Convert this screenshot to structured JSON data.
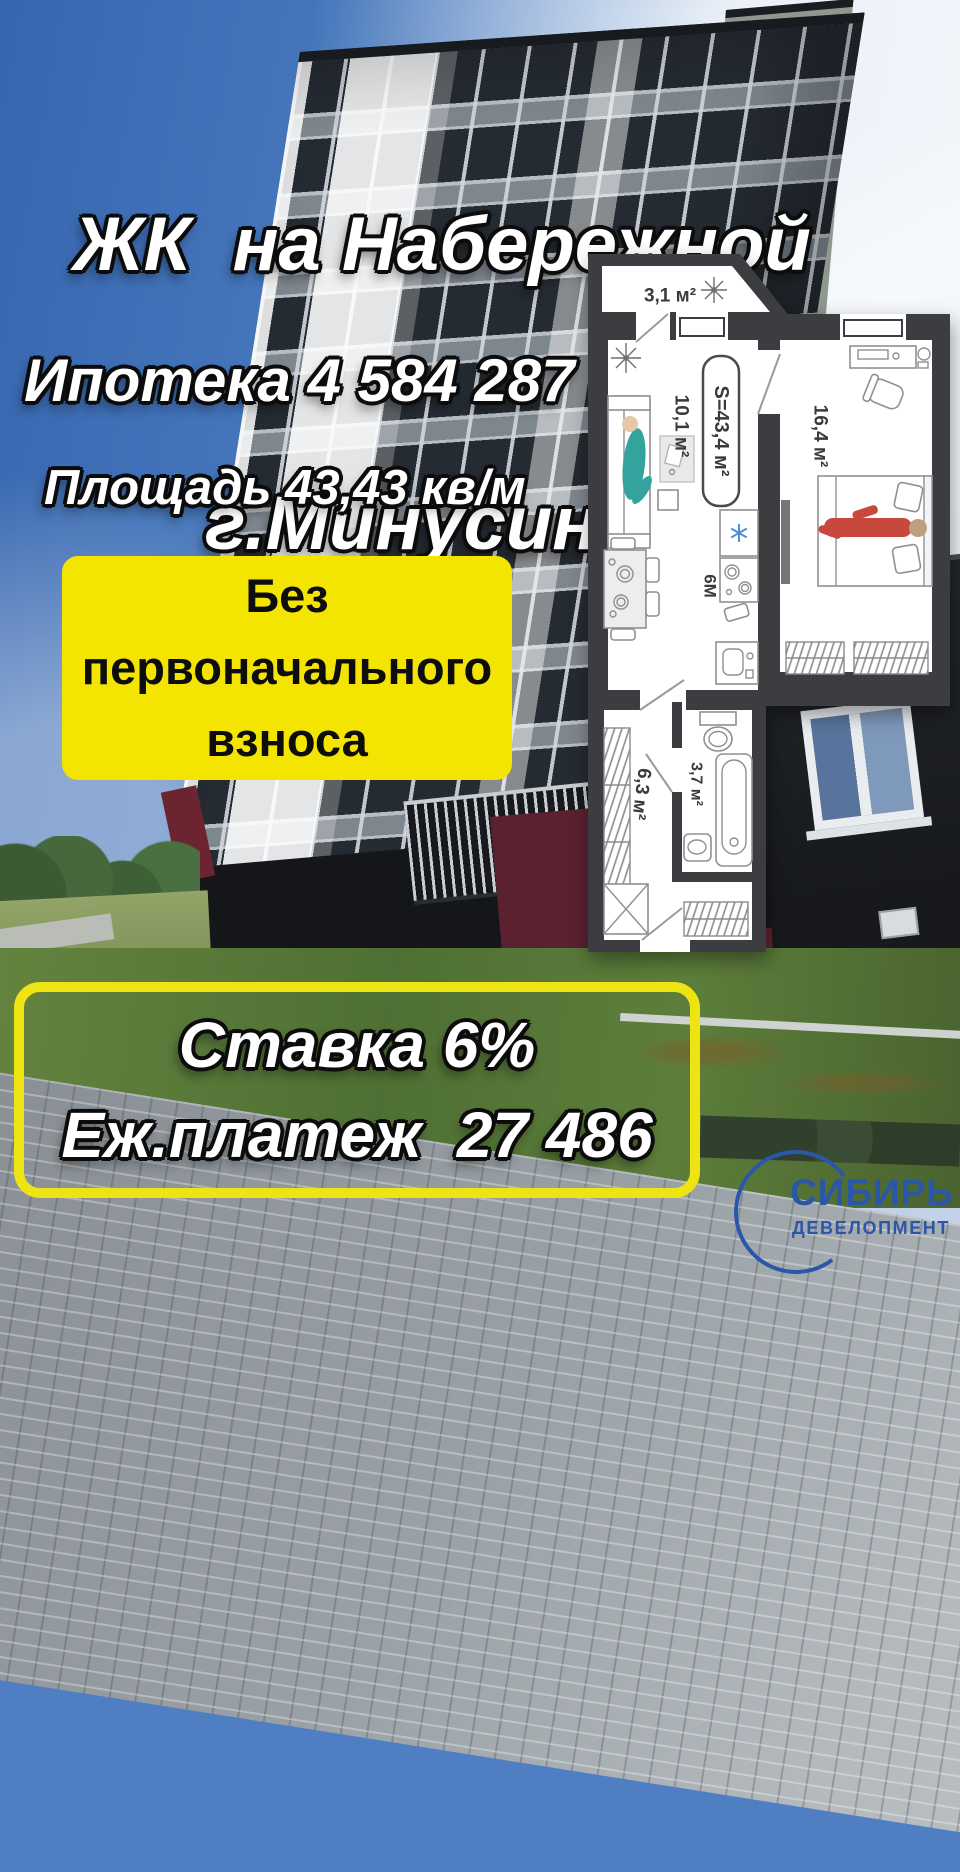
{
  "header": {
    "title_line1": "ЖК  на Набережной",
    "title_line2": "г.Минусинск"
  },
  "prices": {
    "mortgage": "Ипотека 4 584 287",
    "area": "Площадь 43,43 кв/м"
  },
  "offer": {
    "line1": "Без",
    "line2": "первоначального",
    "line3": "взноса"
  },
  "footer": {
    "rate": "Ставка 6%",
    "payment": "Еж.платеж  27 486"
  },
  "floor_plan": {
    "total_area_label": "S=43,4 м²",
    "balcony_area": "3,1 м²",
    "living_area": "10,1 м²",
    "bedroom_area": "16,4 м²",
    "kitchen_area": "6М",
    "hallway_area": "6,3 м²",
    "bathroom_area": "3,7 м²"
  },
  "logo": {
    "title": "СИБИРЬ",
    "subtitle": "ДЕВЕЛОПМЕНТ"
  },
  "colors": {
    "accent_yellow": "#f3e402",
    "logo_blue": "#2b57a8",
    "plan_wall": "#3c3d40",
    "person_red": "#c8483d",
    "person_teal": "#35a39d",
    "snowflake_blue": "#4a90d9"
  }
}
